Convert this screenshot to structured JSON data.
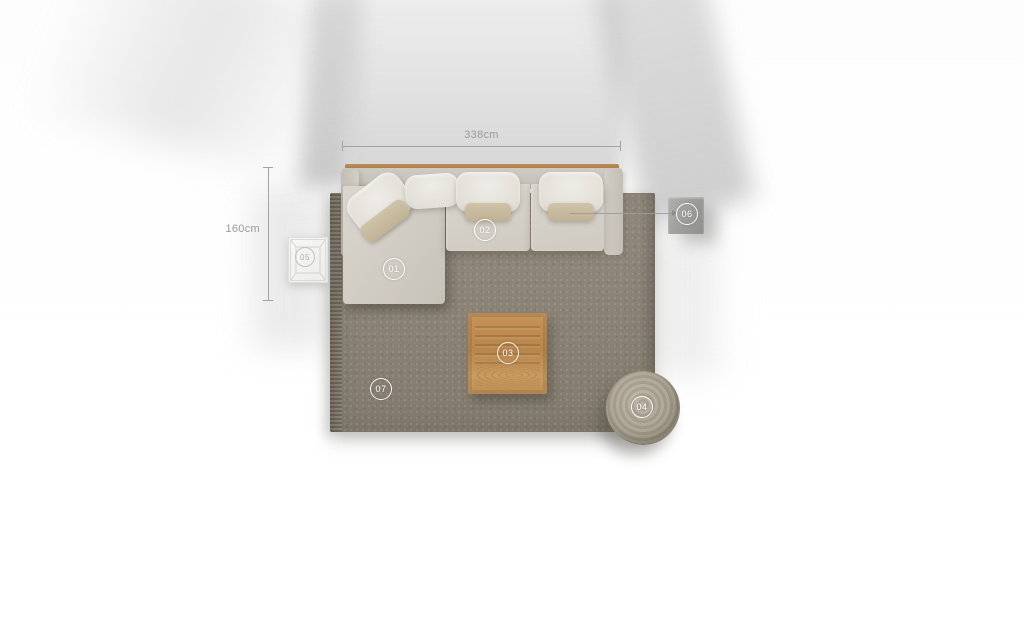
{
  "dimensions": {
    "width_label": "338cm",
    "height_label": "160cm"
  },
  "markers": [
    {
      "label": "01",
      "item": "sofa-chaise-section"
    },
    {
      "label": "02",
      "item": "sofa-middle-seat"
    },
    {
      "label": "03",
      "item": "wooden-coffee-table"
    },
    {
      "label": "04",
      "item": "round-pouf"
    },
    {
      "label": "05",
      "item": "white-side-table"
    },
    {
      "label": "06",
      "item": "grey-side-table"
    },
    {
      "label": "07",
      "item": "area-rug"
    }
  ],
  "colors": {
    "rug": "#8c8476",
    "sofa_body": "#d5d1c9",
    "seat_cushion": "#e9e7e1",
    "accent_pillow": "#c9bda2",
    "coffee_table_wood": "#bf8a4e",
    "pouf": "#a89f8e",
    "side_table_grey": "#9c9c9a",
    "side_table_white": "#f5f5f3",
    "dimension_text": "#9b9b9b",
    "marker_ring": "#ffffff"
  }
}
